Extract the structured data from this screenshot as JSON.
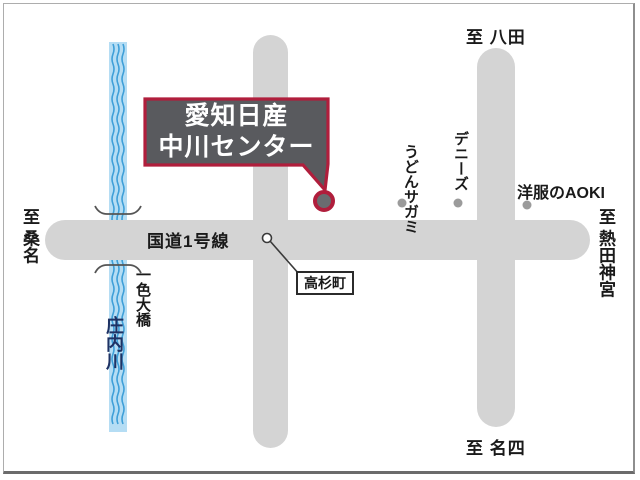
{
  "map": {
    "dealer_callout": {
      "line1": "愛知日産",
      "line2": "中川センター"
    },
    "roads": {
      "route1_label": "国道1号線"
    },
    "directions": {
      "north": "至 八田",
      "west": "至 桑名",
      "east": "至 熱田神宮",
      "south": "至 名四"
    },
    "river": {
      "name": "庄内川",
      "bridge_name": "一色大橋"
    },
    "intersection": {
      "name": "高杉町"
    },
    "landmarks": [
      {
        "name": "うどんサガミ"
      },
      {
        "name": "デニーズ"
      },
      {
        "name": "洋服のAOKI"
      }
    ],
    "colors": {
      "accent_red": "#b01e3c",
      "road_gray": "#d4d4d4",
      "callout_gray": "#595a5e",
      "river_blue": "#b5ddf4",
      "wave_blue": "#3e9fd8",
      "river_text_navy": "#1e3264",
      "landmark_dot_gray": "#9b9b9b"
    }
  }
}
